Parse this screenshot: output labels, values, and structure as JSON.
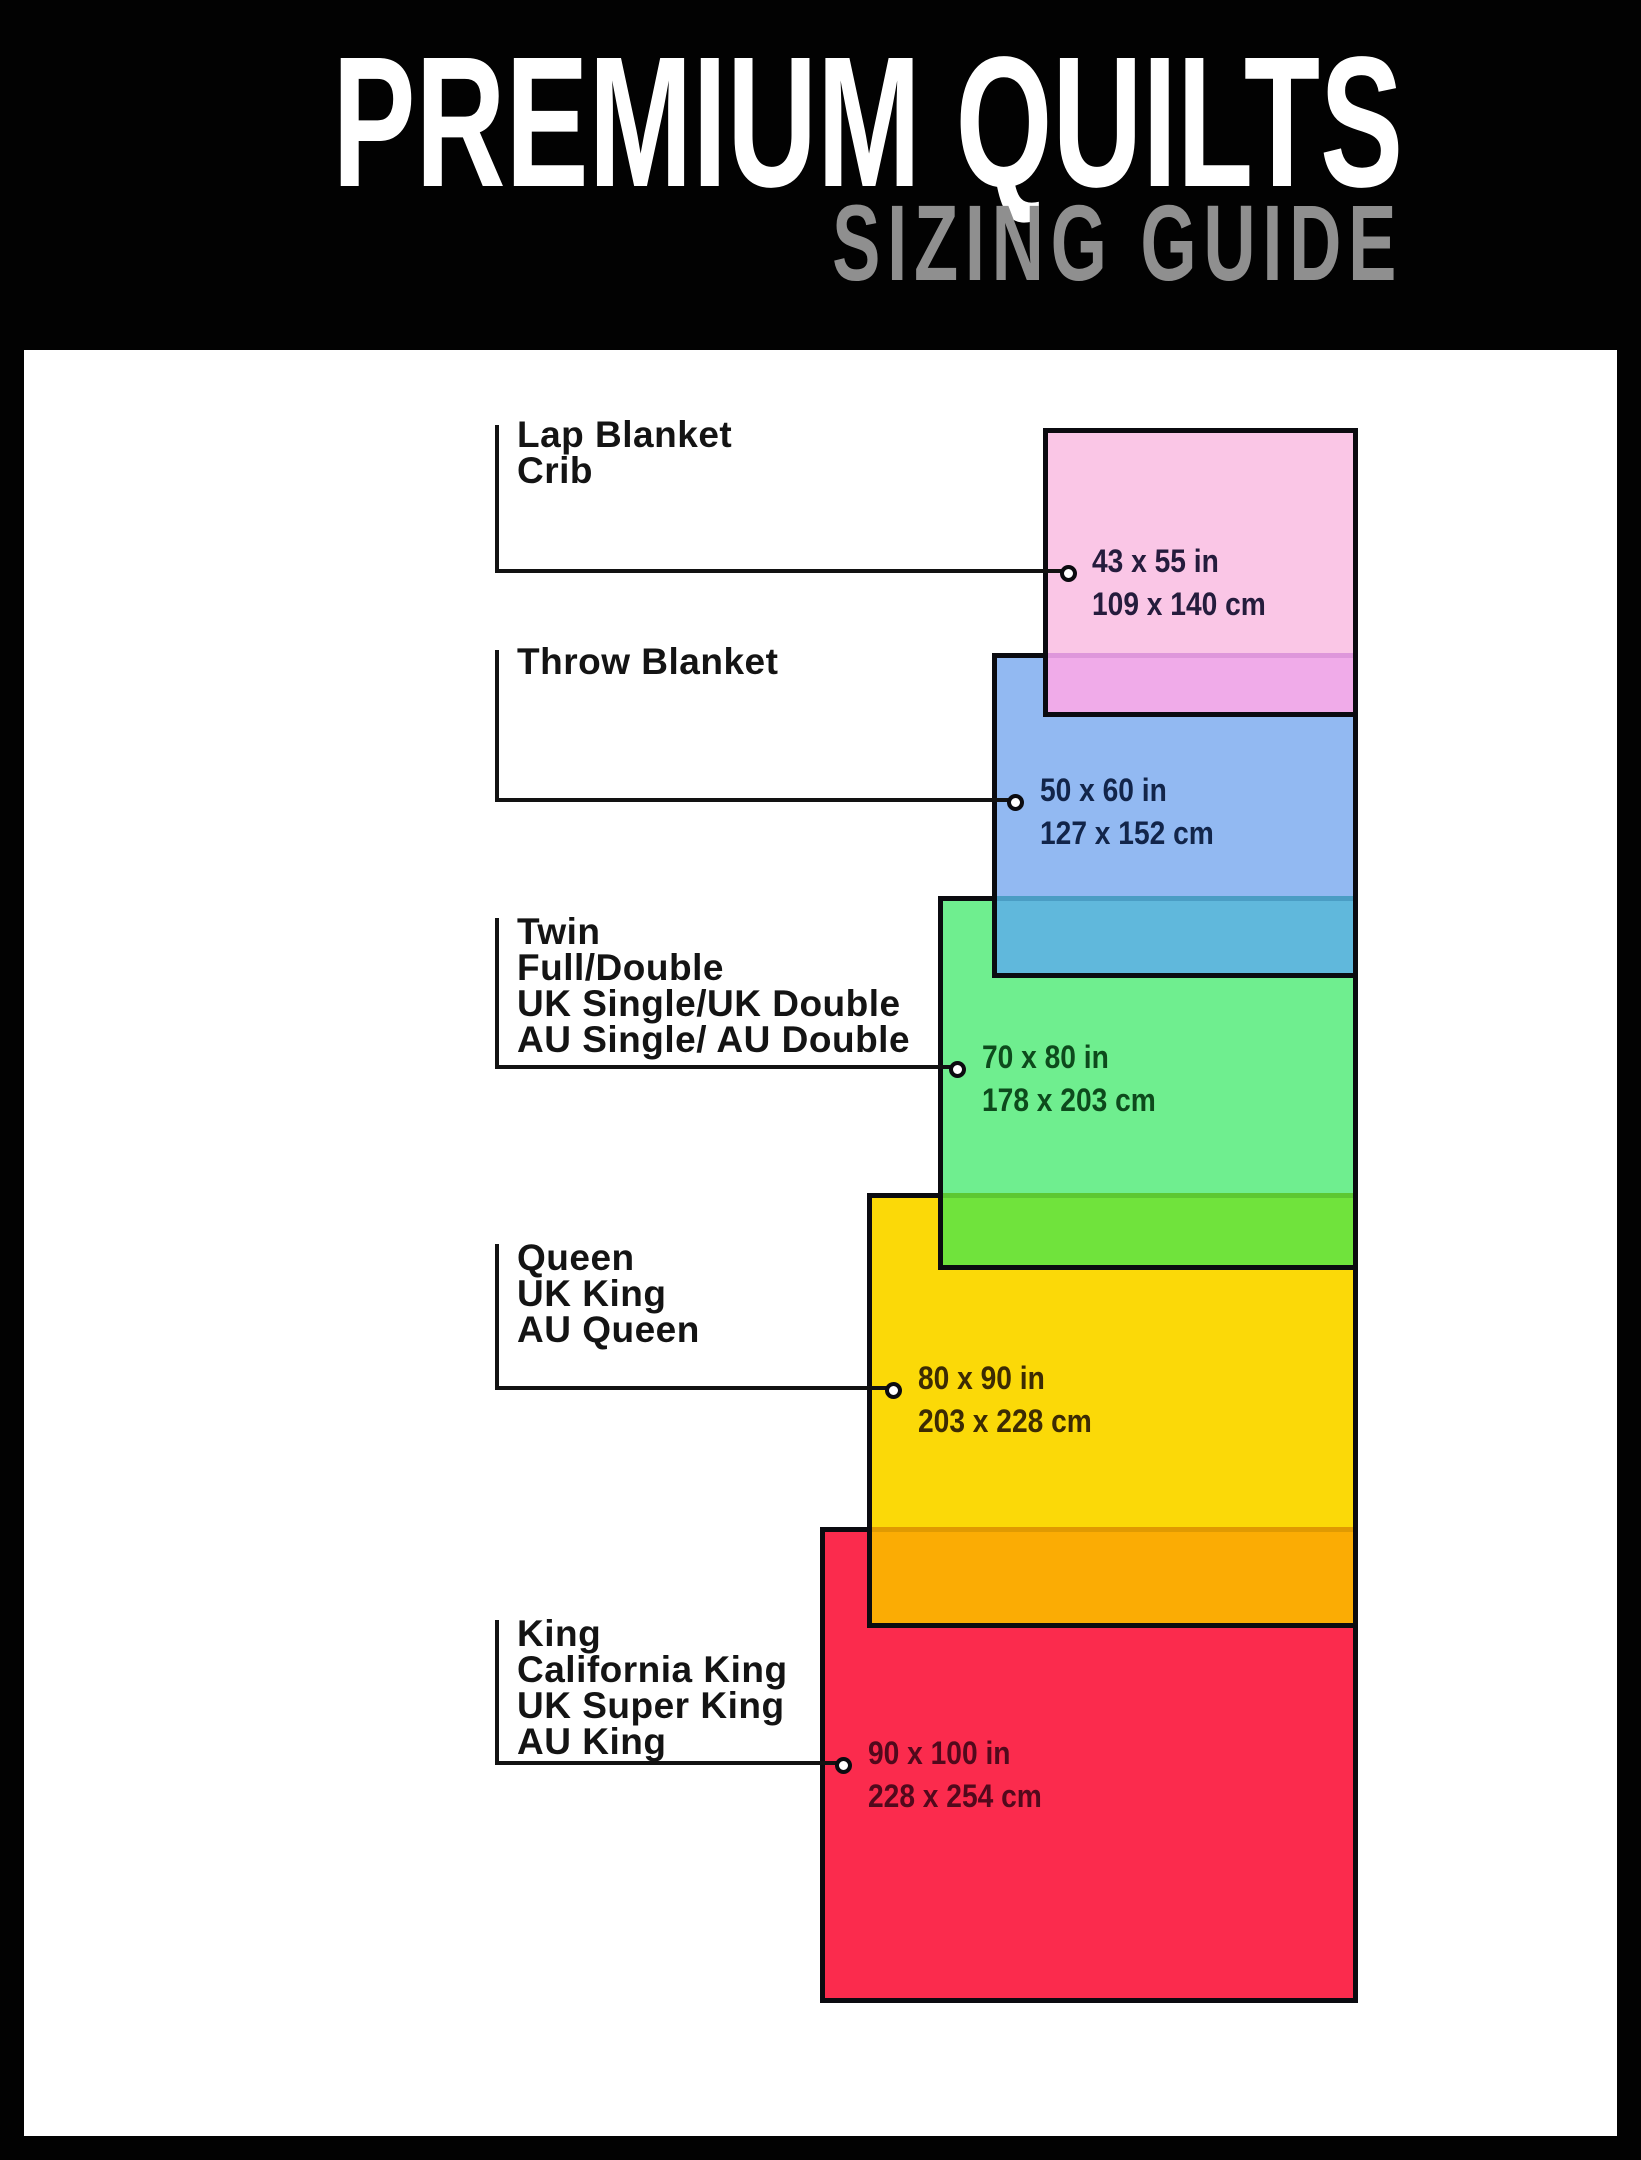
{
  "header": {
    "title": "PREMIUM QUILTS",
    "subtitle": "SIZING GUIDE",
    "background": "#020202",
    "title_color": "#ffffff",
    "subtitle_color": "#8f8f8f"
  },
  "frame_color": "#020202",
  "canvas_color": "#ffffff",
  "sizes": [
    {
      "id": "lap-blanket",
      "labels": [
        "Lap Blanket",
        "Crib"
      ],
      "inches": "43 x 55 in",
      "cm": "109 x 140 cm",
      "fill": "#FAC6E6",
      "overlap_fill": "#F0ABE9",
      "overlap_line": "#DE97DB",
      "text_color": "#251C3D",
      "layout": {
        "left": 1043,
        "top": 428,
        "width": 315,
        "height": 289,
        "overlapStart": 653,
        "labelTop": 417,
        "vTop": 425,
        "hY": 569,
        "cx": 1068,
        "cy": 573,
        "dimsX": 1092,
        "dimsTop": 540
      }
    },
    {
      "id": "throw-blanket",
      "labels": [
        "Throw Blanket"
      ],
      "inches": "50 x 60 in",
      "cm": "127 x 152 cm",
      "fill": "#92B9F2",
      "overlap_fill": "#60B8DC",
      "overlap_line": "#4A9DC4",
      "text_color": "#12254A",
      "layout": {
        "left": 992,
        "top": 653,
        "width": 366,
        "height": 325,
        "overlapStart": 896,
        "labelTop": 644,
        "vTop": 650,
        "hY": 798,
        "cx": 1015,
        "cy": 802,
        "dimsX": 1040,
        "dimsTop": 769
      }
    },
    {
      "id": "twin",
      "labels": [
        "Twin",
        "Full/Double",
        "UK Single/UK Double",
        "AU Single/ AU Double"
      ],
      "inches": "70 x 80 in",
      "cm": "178 x 203 cm",
      "fill": "#6FEE8F",
      "overlap_fill": "#70E33C",
      "overlap_line": "#5CC832",
      "text_color": "#0D4A1C",
      "layout": {
        "left": 938,
        "top": 896,
        "width": 420,
        "height": 374,
        "overlapStart": 1193,
        "labelTop": 914,
        "vTop": 918,
        "hY": 1065,
        "cx": 957,
        "cy": 1069,
        "dimsX": 982,
        "dimsTop": 1036
      }
    },
    {
      "id": "queen",
      "labels": [
        "Queen",
        "UK King",
        "AU Queen"
      ],
      "inches": "80 x 90 in",
      "cm": "203 x 228 cm",
      "fill": "#FBD908",
      "overlap_fill": "#FBAC04",
      "overlap_line": "#E09A02",
      "text_color": "#3C2B03",
      "layout": {
        "left": 867,
        "top": 1193,
        "width": 491,
        "height": 435,
        "overlapStart": 1527,
        "labelTop": 1240,
        "vTop": 1244,
        "hY": 1386,
        "cx": 893,
        "cy": 1390,
        "dimsX": 918,
        "dimsTop": 1357
      }
    },
    {
      "id": "king",
      "labels": [
        "King",
        "California King",
        "UK Super King",
        "AU King"
      ],
      "inches": "90 x 100 in",
      "cm": "228 x 254 cm",
      "fill": "#FB2B4D",
      "overlap_fill": null,
      "overlap_line": null,
      "text_color": "#51091C",
      "layout": {
        "left": 820,
        "top": 1527,
        "width": 538,
        "height": 476,
        "overlapStart": null,
        "labelTop": 1616,
        "vTop": 1620,
        "hY": 1761,
        "cx": 843,
        "cy": 1765,
        "dimsX": 868,
        "dimsTop": 1732
      }
    }
  ],
  "callout_line_x": 495,
  "border_color": "#0b0b10"
}
